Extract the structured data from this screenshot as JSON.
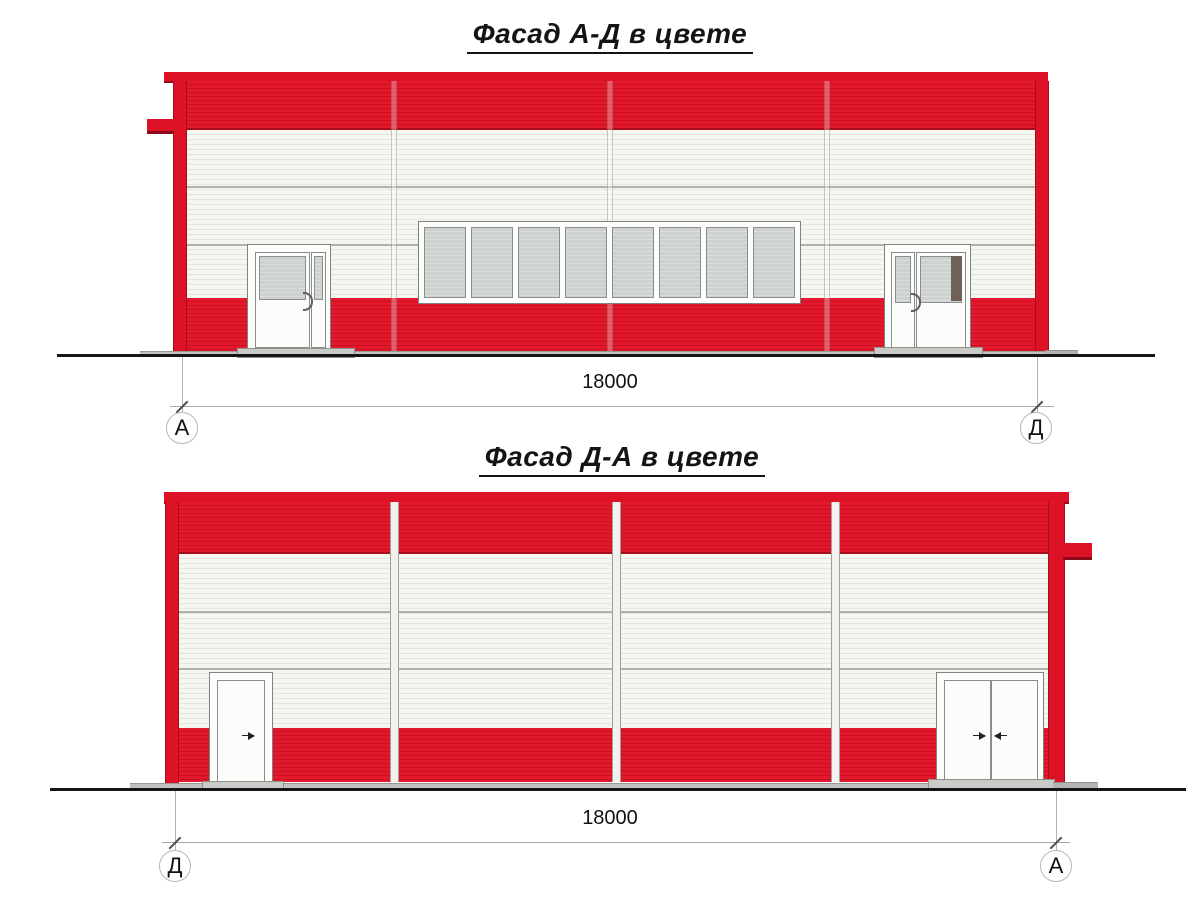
{
  "drawing": {
    "facades": [
      {
        "title": "Фасад А-Д в цвете",
        "dimension_label": "18000",
        "axis_left": "А",
        "axis_right": "Д"
      },
      {
        "title": "Фасад Д-А в цвете",
        "dimension_label": "18000",
        "axis_left": "Д",
        "axis_right": "А"
      }
    ],
    "colors": {
      "facade_red": "#e2182c",
      "facade_red_shadow": "#a80d1e",
      "panel_white": "#f4f6f0",
      "glass_gray": "#d0d4d0",
      "door_brown": "#6e6156",
      "concrete_gray": "#c7c9c5",
      "ground_black": "#161616"
    }
  }
}
